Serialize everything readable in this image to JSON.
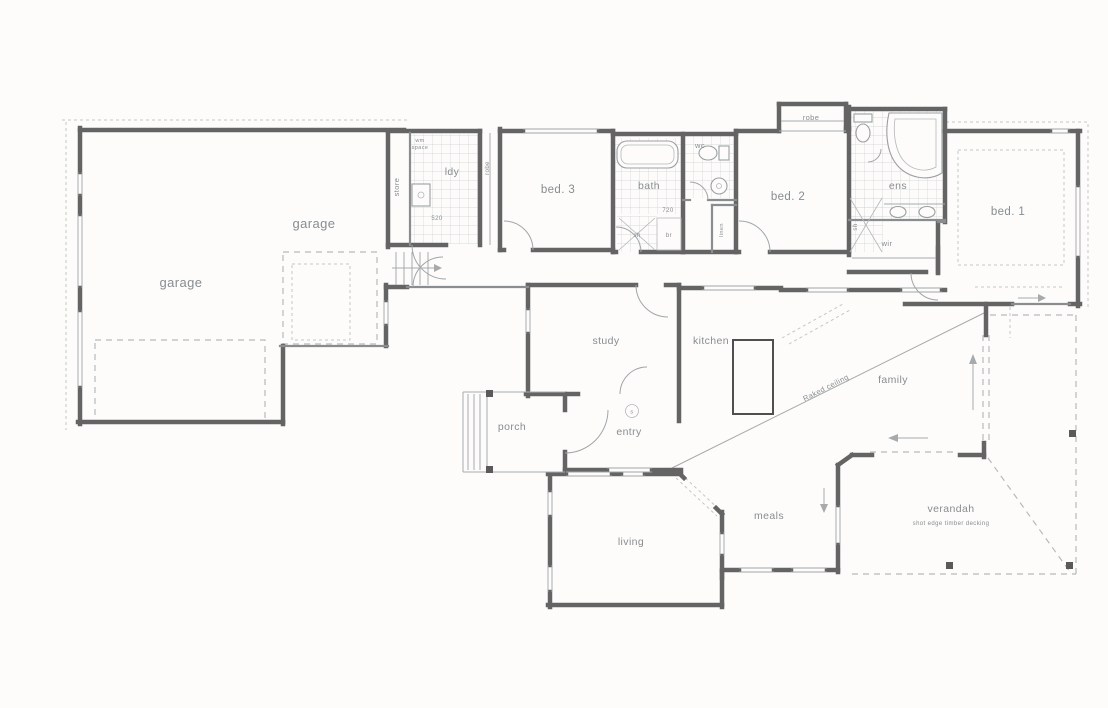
{
  "document": {
    "kind": "scanned residential floor plan"
  },
  "labels": {
    "garage_rear": "garage",
    "garage": "garage",
    "store": "store",
    "ldy": "ldy",
    "wm_line1": "wm",
    "wm_line2": "space",
    "dim_520": "520",
    "robe_bed3": "robe",
    "bed3": "bed. 3",
    "bath": "bath",
    "dim_720": "720",
    "sh_bath": "sh",
    "br": "br",
    "wc": "wc",
    "linen": "linen",
    "robe_bed2": "robe",
    "bed2": "bed. 2",
    "ens": "ens",
    "sh_ens": "sh",
    "wir": "wir",
    "bed1": "bed. 1",
    "study": "study",
    "kitchen": "kitchen",
    "family": "family",
    "raked_ceiling": "Raked ceiling",
    "porch": "porch",
    "entry": "entry",
    "smoke_alarm": "s",
    "meals": "meals",
    "living": "living",
    "verandah": "verandah",
    "verandah_note": "shot edge timber decking"
  },
  "colors": {
    "paper": "#fdfcfa",
    "wall": "#646464",
    "wall_light": "#8a8d90",
    "line": "#a6aaad",
    "dashed": "#b7babc",
    "tile": "#ccd1d5",
    "text": "#878d92"
  }
}
